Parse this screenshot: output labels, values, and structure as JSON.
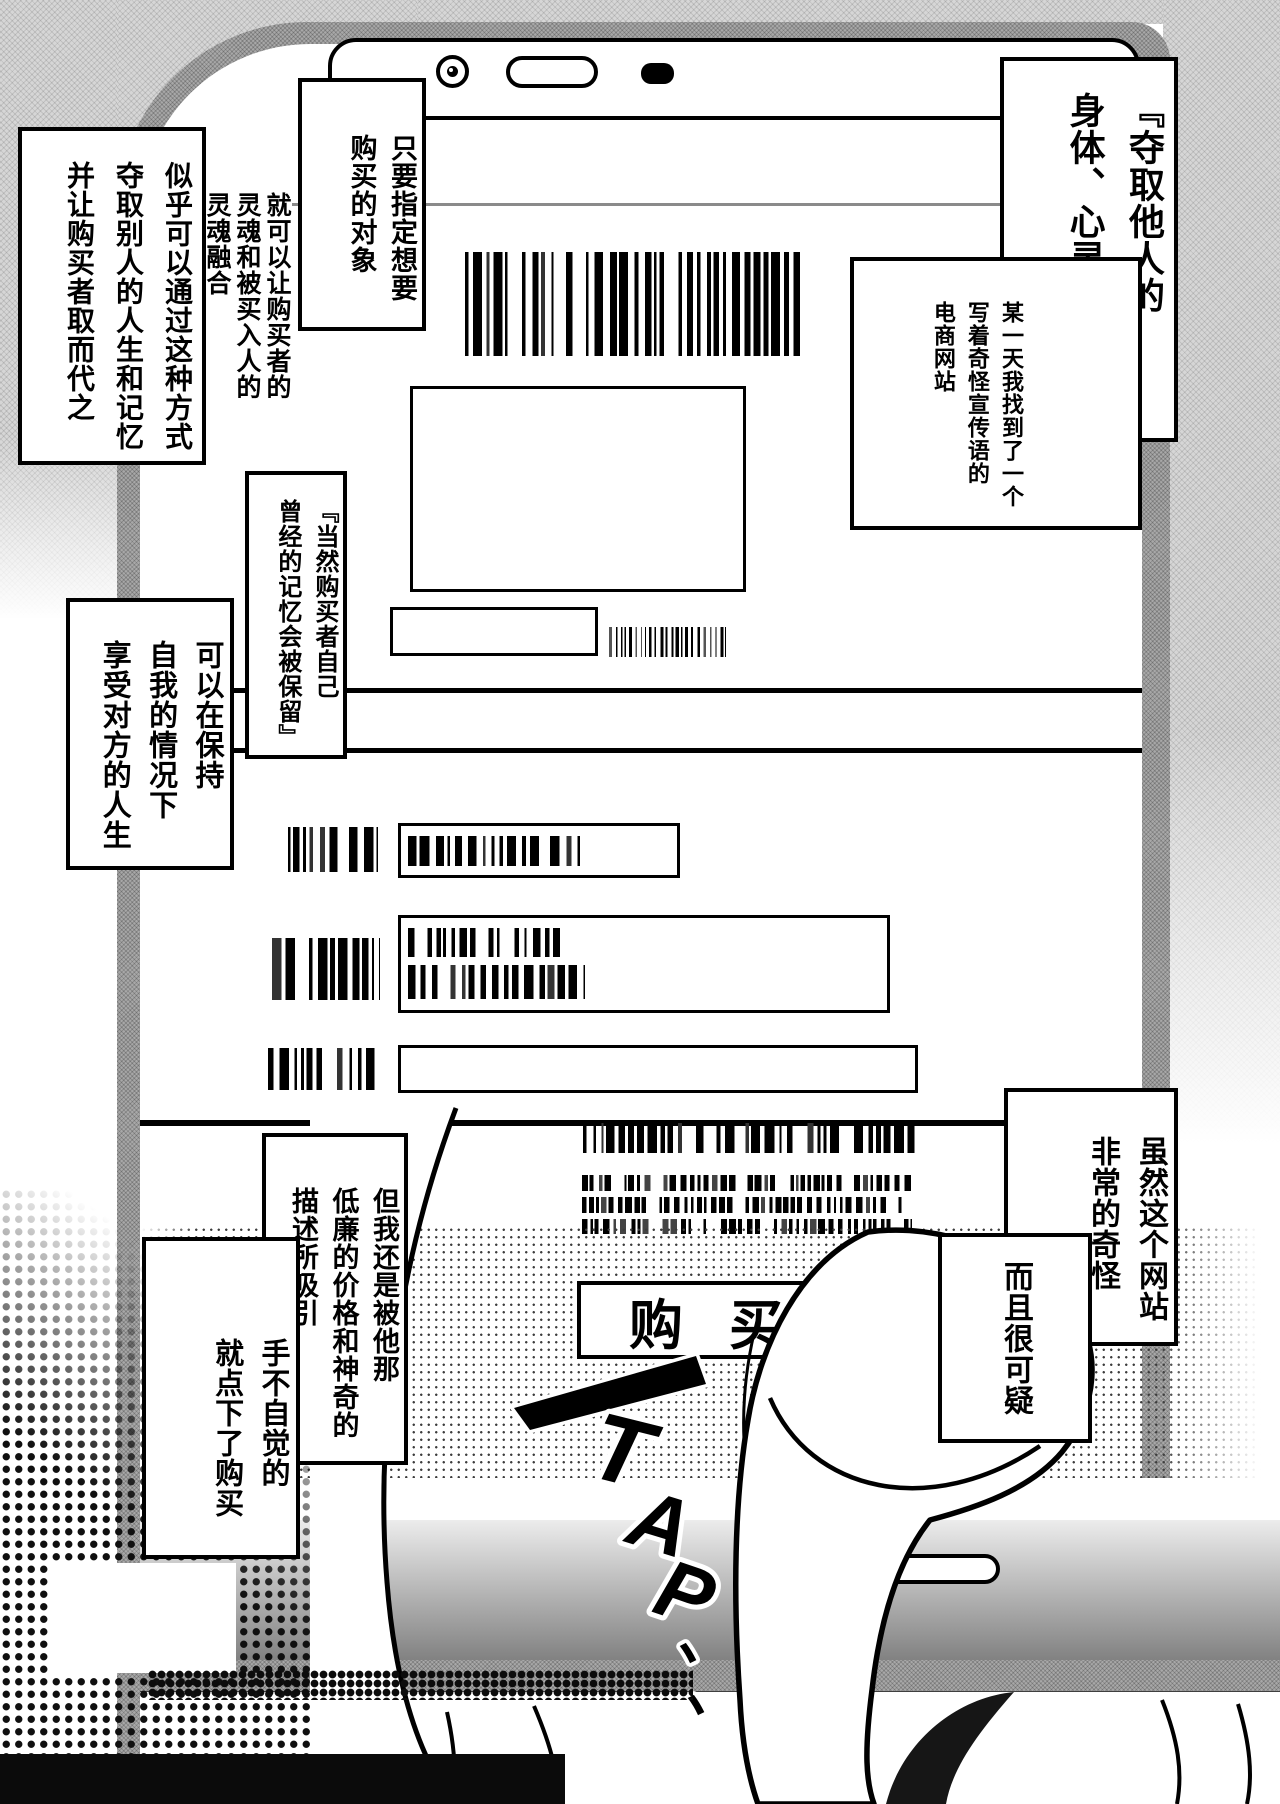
{
  "page": {
    "type": "manga-page",
    "language": "zh-Hans"
  },
  "bubbles": [
    {
      "id": "title-quote",
      "text": "『夺取他人的\n身体、心灵和记忆』"
    },
    {
      "id": "found-site",
      "text": "某一天我找到了一个\n写着奇怪宣传语的\n电商网站"
    },
    {
      "id": "specify-target",
      "text": "只要指定想要\n购买的对象"
    },
    {
      "id": "soul-merge",
      "text": "就可以让购买者的\n灵魂和被买入人的\n灵魂融合"
    },
    {
      "id": "take-over",
      "text": "似乎可以通过这种方式\n夺取别人的人生和记忆\n并让购买者取而代之"
    },
    {
      "id": "memory-kept",
      "text": "『当然购买者自己\n曾经的记忆会被保留』"
    },
    {
      "id": "enjoy-life",
      "text": "可以在保持\n自我的情况下\n享受对方的人生"
    },
    {
      "id": "site-strange",
      "text": "虽然这个网站\n非常的奇怪"
    },
    {
      "id": "suspicious",
      "text": "而且很可疑"
    },
    {
      "id": "attracted",
      "text": "但我还是被他那\n低廉的价格和神奇的\n描述所吸引"
    },
    {
      "id": "tapped-buy",
      "text": "手不自觉的\n就点下了购买"
    }
  ],
  "buy_button": {
    "label": "购买"
  },
  "sfx": {
    "letters": [
      "T",
      "A",
      "P",
      "、",
      "、"
    ]
  },
  "colors": {
    "ink": "#000000",
    "paper": "#ffffff",
    "tone": "#d6d6d6"
  }
}
